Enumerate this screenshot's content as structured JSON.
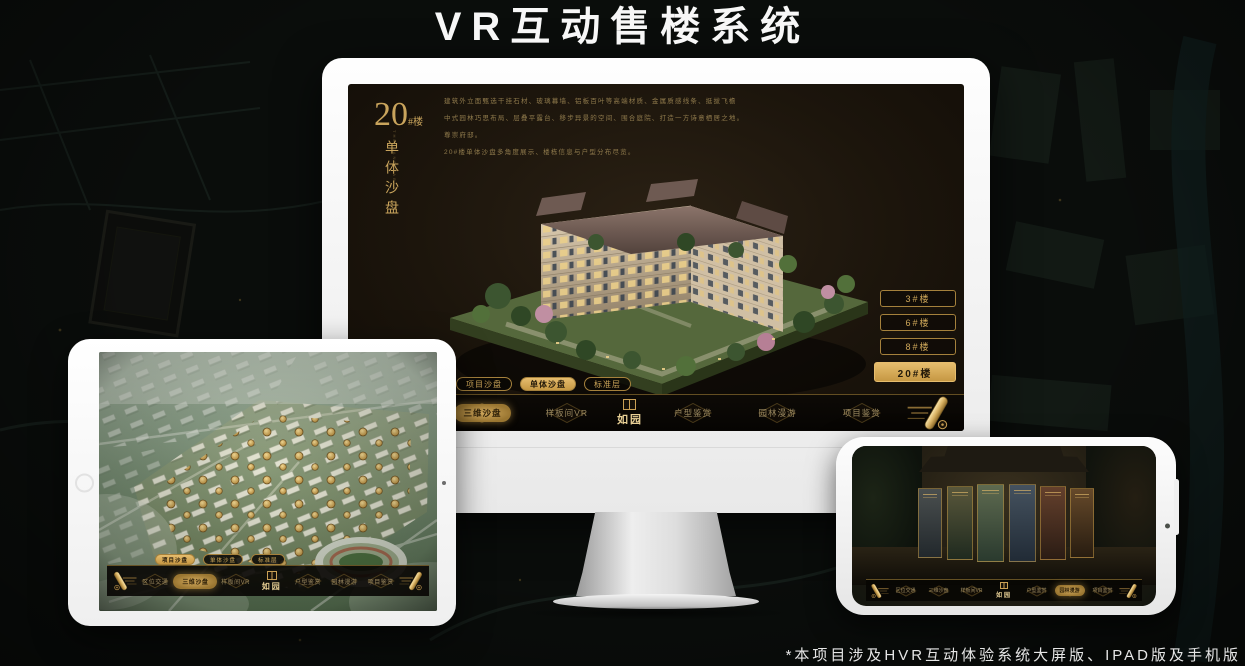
{
  "page": {
    "title": "VR互动售楼系统",
    "footnote": "*本项目涉及HVR互动体验系统大屏版、IPAD版及手机版"
  },
  "colors": {
    "gold_accent": "#c9a45c",
    "gold_active": "#d9ad5f",
    "screen_background": "#1c150c",
    "navbar_background": "#0a0805",
    "device_body": "#f2f2f2"
  },
  "monitor": {
    "title_number": "20",
    "title_suffix": "#楼",
    "subtitle": "单体沙盘",
    "subtitle_en": "THE SAND TABLE",
    "description_lines": [
      "建筑外立面甄选干挂石材、玻璃幕墙、铝板百叶等高端材质、金属质感线条、挺拔飞檐",
      "中式园林巧思布局、层叠平露台、移步异景的空间、围合庭院、打造一方诗意栖居之地。",
      "尊崇府邸。",
      "20#楼单体沙盘多角度展示、楼栋信息与户型分布尽览。"
    ],
    "floor_buttons": [
      {
        "label": "3#楼",
        "active": false
      },
      {
        "label": "6#楼",
        "active": false
      },
      {
        "label": "8#楼",
        "active": false
      },
      {
        "label": "20#楼",
        "active": true
      }
    ],
    "sub_tabs": [
      {
        "label": "项目沙盘",
        "active": false
      },
      {
        "label": "单体沙盘",
        "active": true
      },
      {
        "label": "标准层",
        "active": false
      }
    ],
    "nav": {
      "logo": "如园",
      "items": [
        {
          "label": "区位交通",
          "active": false
        },
        {
          "label": "三维沙盘",
          "active": true
        },
        {
          "label": "样板间VR",
          "active": false
        },
        {
          "label": "户型鉴赏",
          "active": false
        },
        {
          "label": "园林漫游",
          "active": false
        },
        {
          "label": "项目鉴赏",
          "active": false
        }
      ]
    }
  },
  "tablet": {
    "sub_tabs": [
      {
        "label": "项目沙盘",
        "active": true
      },
      {
        "label": "单体沙盘",
        "active": false
      },
      {
        "label": "标准层",
        "active": false
      }
    ],
    "nav": {
      "logo": "如园",
      "items": [
        {
          "label": "区位交通",
          "active": false
        },
        {
          "label": "三维沙盘",
          "active": true
        },
        {
          "label": "样板间VR",
          "active": false
        },
        {
          "label": "户型鉴赏",
          "active": false
        },
        {
          "label": "园林漫游",
          "active": false
        },
        {
          "label": "项目鉴赏",
          "active": false
        }
      ]
    }
  },
  "phone": {
    "nav": {
      "logo": "如园",
      "items": [
        {
          "label": "区位交通",
          "active": false
        },
        {
          "label": "三维沙盘",
          "active": false
        },
        {
          "label": "样板间VR",
          "active": false
        },
        {
          "label": "户型鉴赏",
          "active": false
        },
        {
          "label": "园林漫游",
          "active": true
        },
        {
          "label": "项目鉴赏",
          "active": false
        }
      ]
    }
  }
}
